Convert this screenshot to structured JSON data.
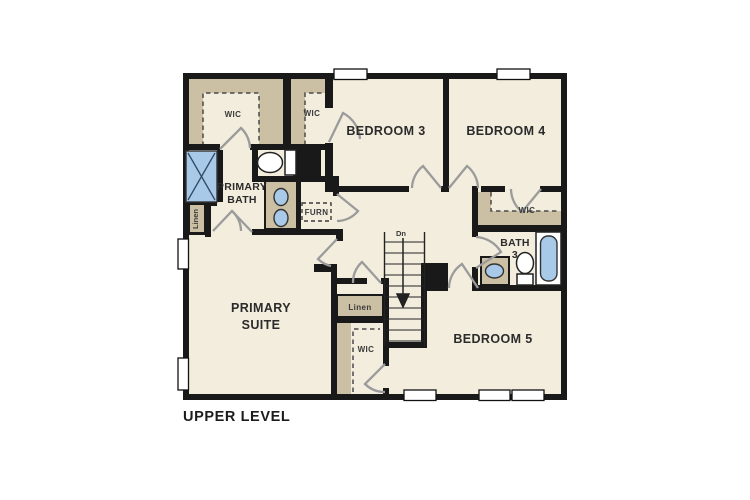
{
  "floorplan": {
    "title": "UPPER LEVEL",
    "stairs": {
      "direction_label": "Dn"
    },
    "rooms": {
      "wic_primary": "WIC",
      "wic_bedroom3": "WIC",
      "bedroom3": "BEDROOM 3",
      "bedroom4": "BEDROOM 4",
      "primary_bath_line1": "PRIMARY",
      "primary_bath_line2": "BATH",
      "linen_upper": "Linen",
      "furnace": "FURN",
      "wic_bedroom4": "WIC",
      "bath3_line1": "BATH",
      "bath3_line2": "3",
      "primary_suite_line1": "PRIMARY",
      "primary_suite_line2": "SUITE",
      "linen_lower": "Linen",
      "wic_bedroom5": "WIC",
      "bedroom5": "BEDROOM 5"
    },
    "colors": {
      "floor": "#f3edde",
      "wall": "#191919",
      "shelf": "#ccc0a4",
      "fixture": "#a9c9e8",
      "door": "#9b9b9b",
      "text": "#2b2b2b"
    }
  }
}
